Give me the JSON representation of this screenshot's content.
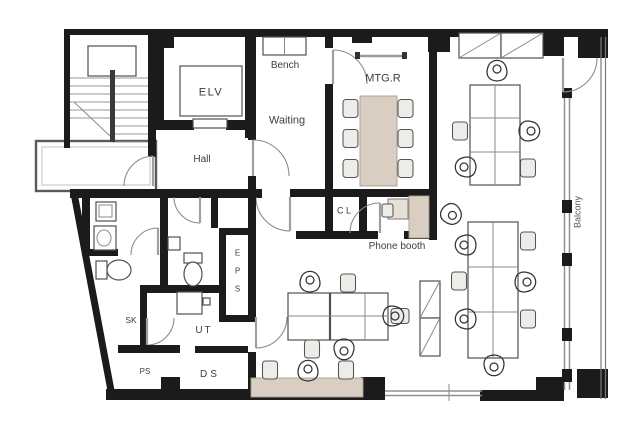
{
  "rooms": {
    "bench": "Bench",
    "waiting": "Waiting",
    "mtg": "MTG.R",
    "elv": "ELV",
    "hall": "Hall",
    "cl": "C L",
    "phone": "Phone booth",
    "eps": "E P S",
    "balcony": "Balcony",
    "sk": "SK",
    "ut": "UT",
    "ps": "PS",
    "ds": "DS"
  },
  "colors": {
    "wall": "#1b1b1b",
    "tan": "#d8cec1",
    "line": "#4f4f4f",
    "label": "#3d3d3d"
  }
}
